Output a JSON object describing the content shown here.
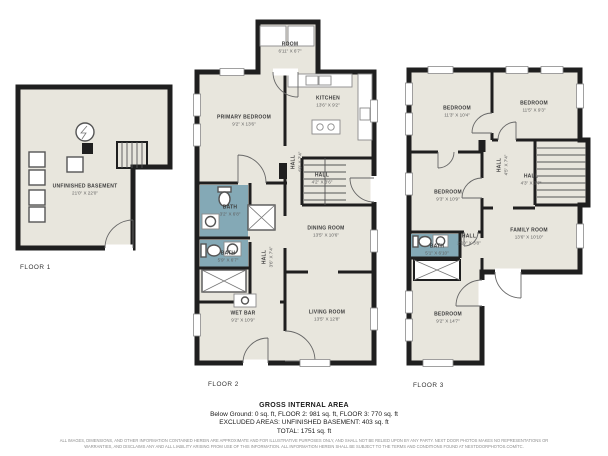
{
  "colors": {
    "wall": "#1f1f1f",
    "room_fill": "#e8e6dd",
    "bath_fill": "#84a9b6",
    "label_text": "#3c3c3c"
  },
  "floors": [
    {
      "label": "FLOOR 1",
      "rooms": [
        {
          "name": "UNFINISHED BASEMENT",
          "dims": "21'0\" X 22'0\""
        }
      ]
    },
    {
      "label": "FLOOR 2",
      "rooms": [
        {
          "name": "ROOM",
          "dims": "6'11\" X 6'7\""
        },
        {
          "name": "KITCHEN",
          "dims": "13'6\" X 9'2\""
        },
        {
          "name": "PRIMARY BEDROOM",
          "dims": "9'2\" X 13'6\""
        },
        {
          "name": "HALL",
          "dims": "4'0\" X 7'4\""
        },
        {
          "name": "HALL",
          "dims": "4'2\" X 3'6\""
        },
        {
          "name": "BATH",
          "dims": "3'2\" X 6'8\""
        },
        {
          "name": "BATH",
          "dims": "5'9\" X 6'7\""
        },
        {
          "name": "HALL",
          "dims": "3'6\" X 7'4\""
        },
        {
          "name": "DINING ROOM",
          "dims": "13'5\" X 10'6\""
        },
        {
          "name": "LIVING ROOM",
          "dims": "13'5\" X 12'8\""
        },
        {
          "name": "WET BAR",
          "dims": "9'2\" X 10'9\""
        }
      ]
    },
    {
      "label": "FLOOR 3",
      "rooms": [
        {
          "name": "BEDROOM",
          "dims": "11'3\" X 10'4\""
        },
        {
          "name": "BEDROOM",
          "dims": "11'5\" X 9'3\""
        },
        {
          "name": "BEDROOM",
          "dims": "9'3\" X 10'9\""
        },
        {
          "name": "HALL",
          "dims": "4'5\" X 7'4\""
        },
        {
          "name": "HALL",
          "dims": "4'3\" X 3'7\""
        },
        {
          "name": "BATH",
          "dims": "5'1\" X 6'10\""
        },
        {
          "name": "HALL",
          "dims": "2'10\" X 3'8\""
        },
        {
          "name": "FAMILY ROOM",
          "dims": "13'6\" X 10'10\""
        },
        {
          "name": "BEDROOM",
          "dims": "9'2\" X 14'7\""
        }
      ]
    }
  ],
  "footer": {
    "title": "GROSS INTERNAL AREA",
    "line1": "Below Ground: 0 sq. ft, FLOOR 2: 981 sq. ft, FLOOR 3: 770 sq. ft",
    "line2": "EXCLUDED AREAS: UNFINISHED BASEMENT: 403 sq. ft",
    "line3": "TOTAL: 1751 sq. ft",
    "disclaimer": "ALL IMAGES, DIMENSIONS, AND OTHER INFORMATION CONTAINED HEREIN ARE APPROXIMATE AND FOR ILLUSTRATIVE PURPOSES ONLY, AND SHALL NOT BE RELIED UPON BY ANY PARTY. NEXT DOOR PHOTOS MAKES NO REPRESENTATIONS OR WARRANTIES, AND DISCLAIMS ANY AND ALL LIABILITY ARISING FROM USE OF THIS INFORMATION. ALL INFORMATION HEREIN SHALL BE SUBJECT TO THE TERMS AND CONDITIONS FOUND AT NEXTDOORPHOTOS.COM/TC."
  }
}
